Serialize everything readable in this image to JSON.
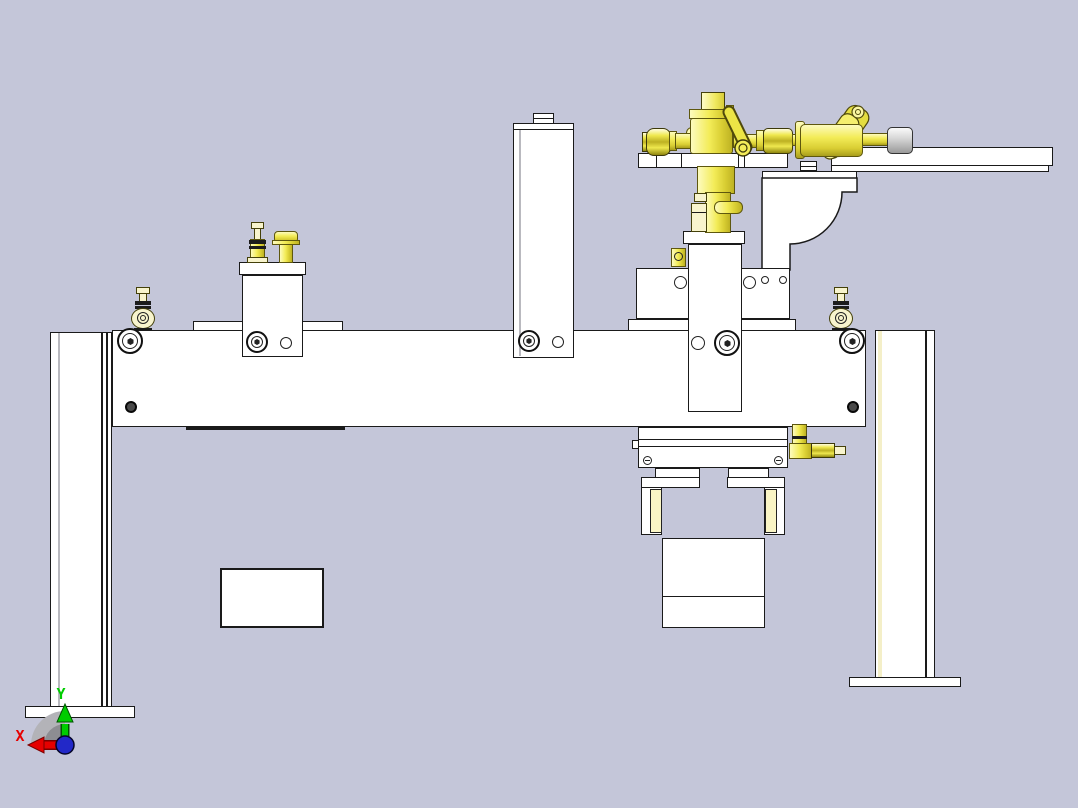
{
  "window": {
    "type": "cad-viewport",
    "description": "3D CAD front view of a pneumatic gantry clamp fixture assembly"
  },
  "viewport": {
    "background": "#c4c6d9",
    "part_color": "#ffffff",
    "edge_color": "#1a1a1a",
    "highlight_yellow": "#f3ec58",
    "highlight_pale": "#f8f4cd",
    "pad_color": "#faf5c5"
  },
  "triad": {
    "x_label": "X",
    "y_label": "Y",
    "x_color": "#e60000",
    "y_color": "#00cc00",
    "z_color": "#2228c8"
  }
}
